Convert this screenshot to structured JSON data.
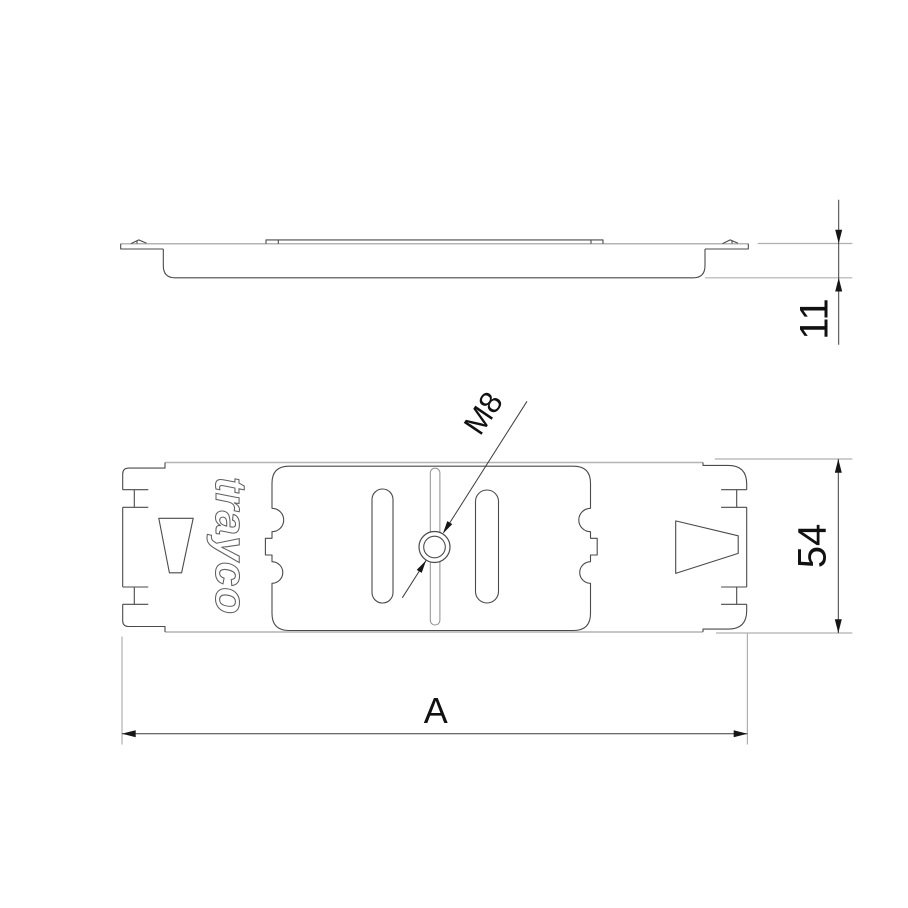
{
  "drawing": {
    "title": "clamp-plate-two-view-drawing",
    "logo_text": "trayco",
    "dimensions": {
      "thickness": "11",
      "width": "54",
      "length": "A"
    },
    "hole_callout": "M8",
    "colors": {
      "background": "#ffffff",
      "outline": "#4a4a4a",
      "light_edge": "#b4b4b4",
      "dimension_line": "#3c3c3c",
      "text": "#111111"
    }
  }
}
